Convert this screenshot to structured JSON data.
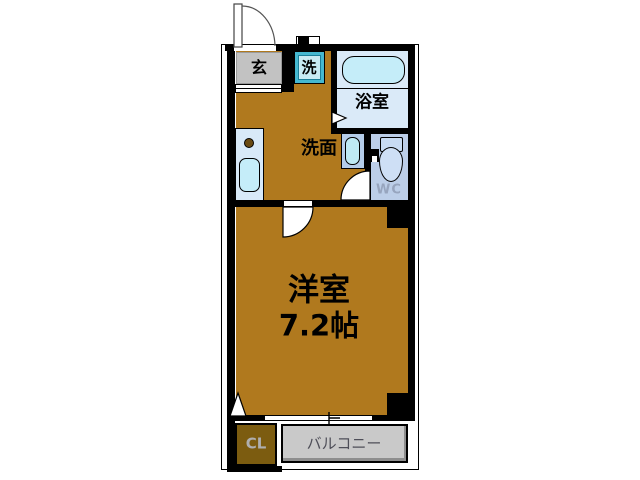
{
  "plan": {
    "type": "apartment-floor-plan",
    "rooms": {
      "entrance": {
        "label": "玄"
      },
      "laundry": {
        "label": "洗"
      },
      "bathroom": {
        "label": "浴室"
      },
      "washroom": {
        "label": "洗面"
      },
      "toilet": {
        "label": "WC"
      },
      "living": {
        "name": "洋室",
        "size": "7.2帖"
      },
      "closet": {
        "label": "CL"
      },
      "balcony": {
        "label": "バルコニー"
      }
    },
    "colors": {
      "floor": "#B0791E",
      "closet_floor": "#7C5C10",
      "entrance_floor": "#C2C2C2",
      "balcony_floor": "#C9C9C9",
      "bath_floor": "#DAEAF8",
      "fixture_cyan": "#C5EDF9",
      "counter_blue": "#D8E9F8",
      "basin_box_blue": "#B5CDE9",
      "wc_floor": "#BCCEE8",
      "laundry_frame": "#45B8D0",
      "burner_brown": "#6A4A12",
      "wall": "#000000",
      "wc_text": "#97A5BE",
      "balcony_text": "#4E4E58",
      "closet_text": "#AFAFAF"
    },
    "icons": {
      "bathtub": "rounded-rect",
      "toilet": "tank-and-bowl",
      "washbasin": "pill-oval",
      "kitchen_sink": "rounded-rect",
      "burner": "circle",
      "doors": "quarter-arc",
      "sliding_door_marker": "triangle"
    }
  }
}
